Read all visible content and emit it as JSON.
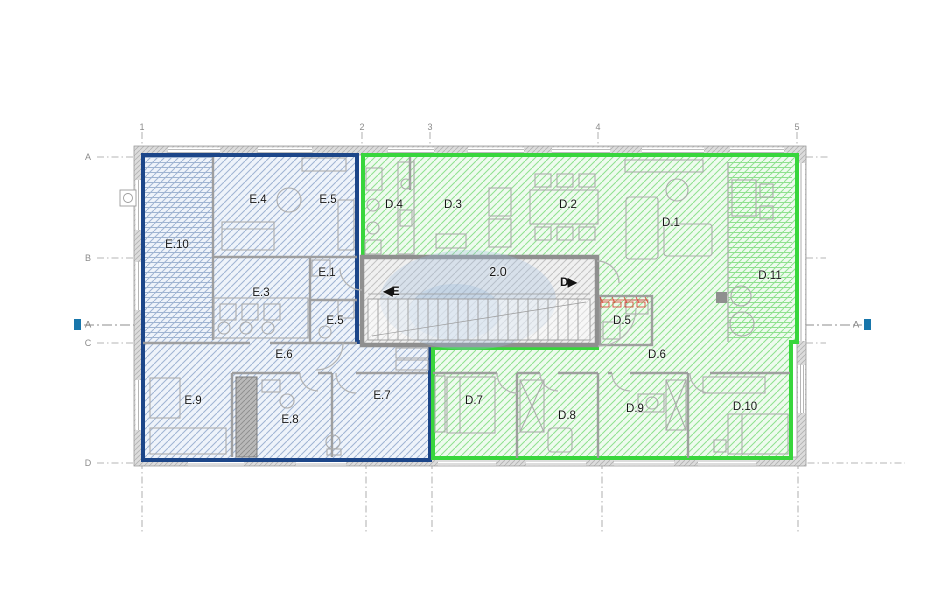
{
  "drawing": {
    "type": "floor-plan",
    "stairwell": {
      "number": "2.0",
      "entrance_e_label": "◀E",
      "entrance_d_label": "D▶"
    },
    "units": [
      {
        "id": "E",
        "outline_color": "#1c4689",
        "fill": "#edf2fa",
        "hatch": "#9fb4d2",
        "rooms": [
          {
            "label": "E.4",
            "x": 258,
            "y": 200
          },
          {
            "label": "E.5",
            "x": 328,
            "y": 200
          },
          {
            "label": "E.10",
            "x": 177,
            "y": 245
          },
          {
            "label": "E.1",
            "x": 327,
            "y": 273
          },
          {
            "label": "E.3",
            "x": 261,
            "y": 293
          },
          {
            "label": "E.5",
            "x": 335,
            "y": 321
          },
          {
            "label": "E.6",
            "x": 284,
            "y": 355
          },
          {
            "label": "E.9",
            "x": 193,
            "y": 401
          },
          {
            "label": "E.8",
            "x": 290,
            "y": 420
          },
          {
            "label": "E.7",
            "x": 382,
            "y": 396
          }
        ]
      },
      {
        "id": "D",
        "outline_color": "#38d63c",
        "fill": "#eefbee",
        "hatch": "#8fe18f",
        "rooms": [
          {
            "label": "D.4",
            "x": 394,
            "y": 205
          },
          {
            "label": "D.3",
            "x": 453,
            "y": 205
          },
          {
            "label": "D.2",
            "x": 568,
            "y": 205
          },
          {
            "label": "D.1",
            "x": 671,
            "y": 223
          },
          {
            "label": "D.11",
            "x": 770,
            "y": 276
          },
          {
            "label": "D.5",
            "x": 622,
            "y": 321
          },
          {
            "label": "D.6",
            "x": 657,
            "y": 355
          },
          {
            "label": "D.7",
            "x": 474,
            "y": 401
          },
          {
            "label": "D.8",
            "x": 567,
            "y": 416
          },
          {
            "label": "D.9",
            "x": 635,
            "y": 409
          },
          {
            "label": "D.10",
            "x": 745,
            "y": 407
          }
        ]
      }
    ],
    "grid": {
      "columns": [
        {
          "label": "1",
          "x": 142
        },
        {
          "label": "2",
          "x": 362
        },
        {
          "label": "3",
          "x": 430
        },
        {
          "label": "4",
          "x": 598
        },
        {
          "label": "5",
          "x": 797
        }
      ],
      "rows": [
        {
          "label": "A",
          "x": 88,
          "y": 157
        },
        {
          "label": "B",
          "x": 88,
          "y": 258
        },
        {
          "label": "C",
          "x": 88,
          "y": 343
        },
        {
          "label": "D",
          "x": 88,
          "y": 463
        }
      ]
    },
    "section_line": {
      "left": {
        "label": "A",
        "x": 88,
        "y": 325
      },
      "right": {
        "label": "A",
        "x": 856,
        "y": 325
      }
    },
    "colors": {
      "stair_outline": "#8f8f8f",
      "walls": "#9b9b9b",
      "section_marker": "#1876ab",
      "annotation_red": "#d93a2b",
      "watermark": "#9fbedd"
    }
  }
}
